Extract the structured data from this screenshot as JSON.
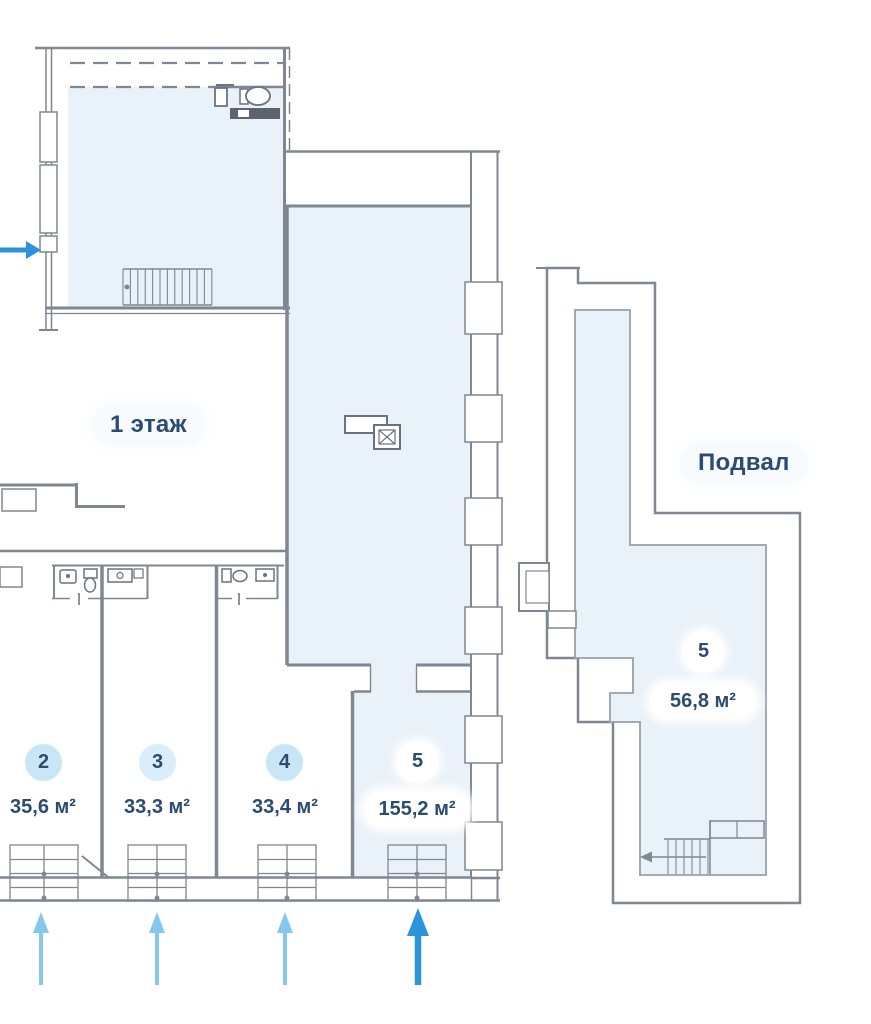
{
  "plan": {
    "floor1_label": "1 этаж",
    "basement_label": "Подвал",
    "floor1_units": [
      {
        "number": "2",
        "area": "35,6 м²",
        "highlighted": false
      },
      {
        "number": "3",
        "area": "33,3 м²",
        "highlighted": false
      },
      {
        "number": "4",
        "area": "33,4 м²",
        "highlighted": false
      },
      {
        "number": "5",
        "area": "155,2 м²",
        "highlighted": true
      }
    ],
    "basement_units": [
      {
        "number": "5",
        "area": "56,8 м²",
        "highlighted": true
      }
    ],
    "icons": {
      "entrance_arrows": "entrance-arrow-icon",
      "stairs": "stairs-icon",
      "toilet": "toilet-icon",
      "sink": "sink-icon"
    },
    "colors": {
      "room_fill": "#e9f2f8",
      "wall": "#7f8792",
      "label_text": "#2c4b70",
      "badge_fill": "#c9e6f7",
      "arrow_light": "#85c8ee",
      "arrow_accent": "#2a95da"
    }
  }
}
